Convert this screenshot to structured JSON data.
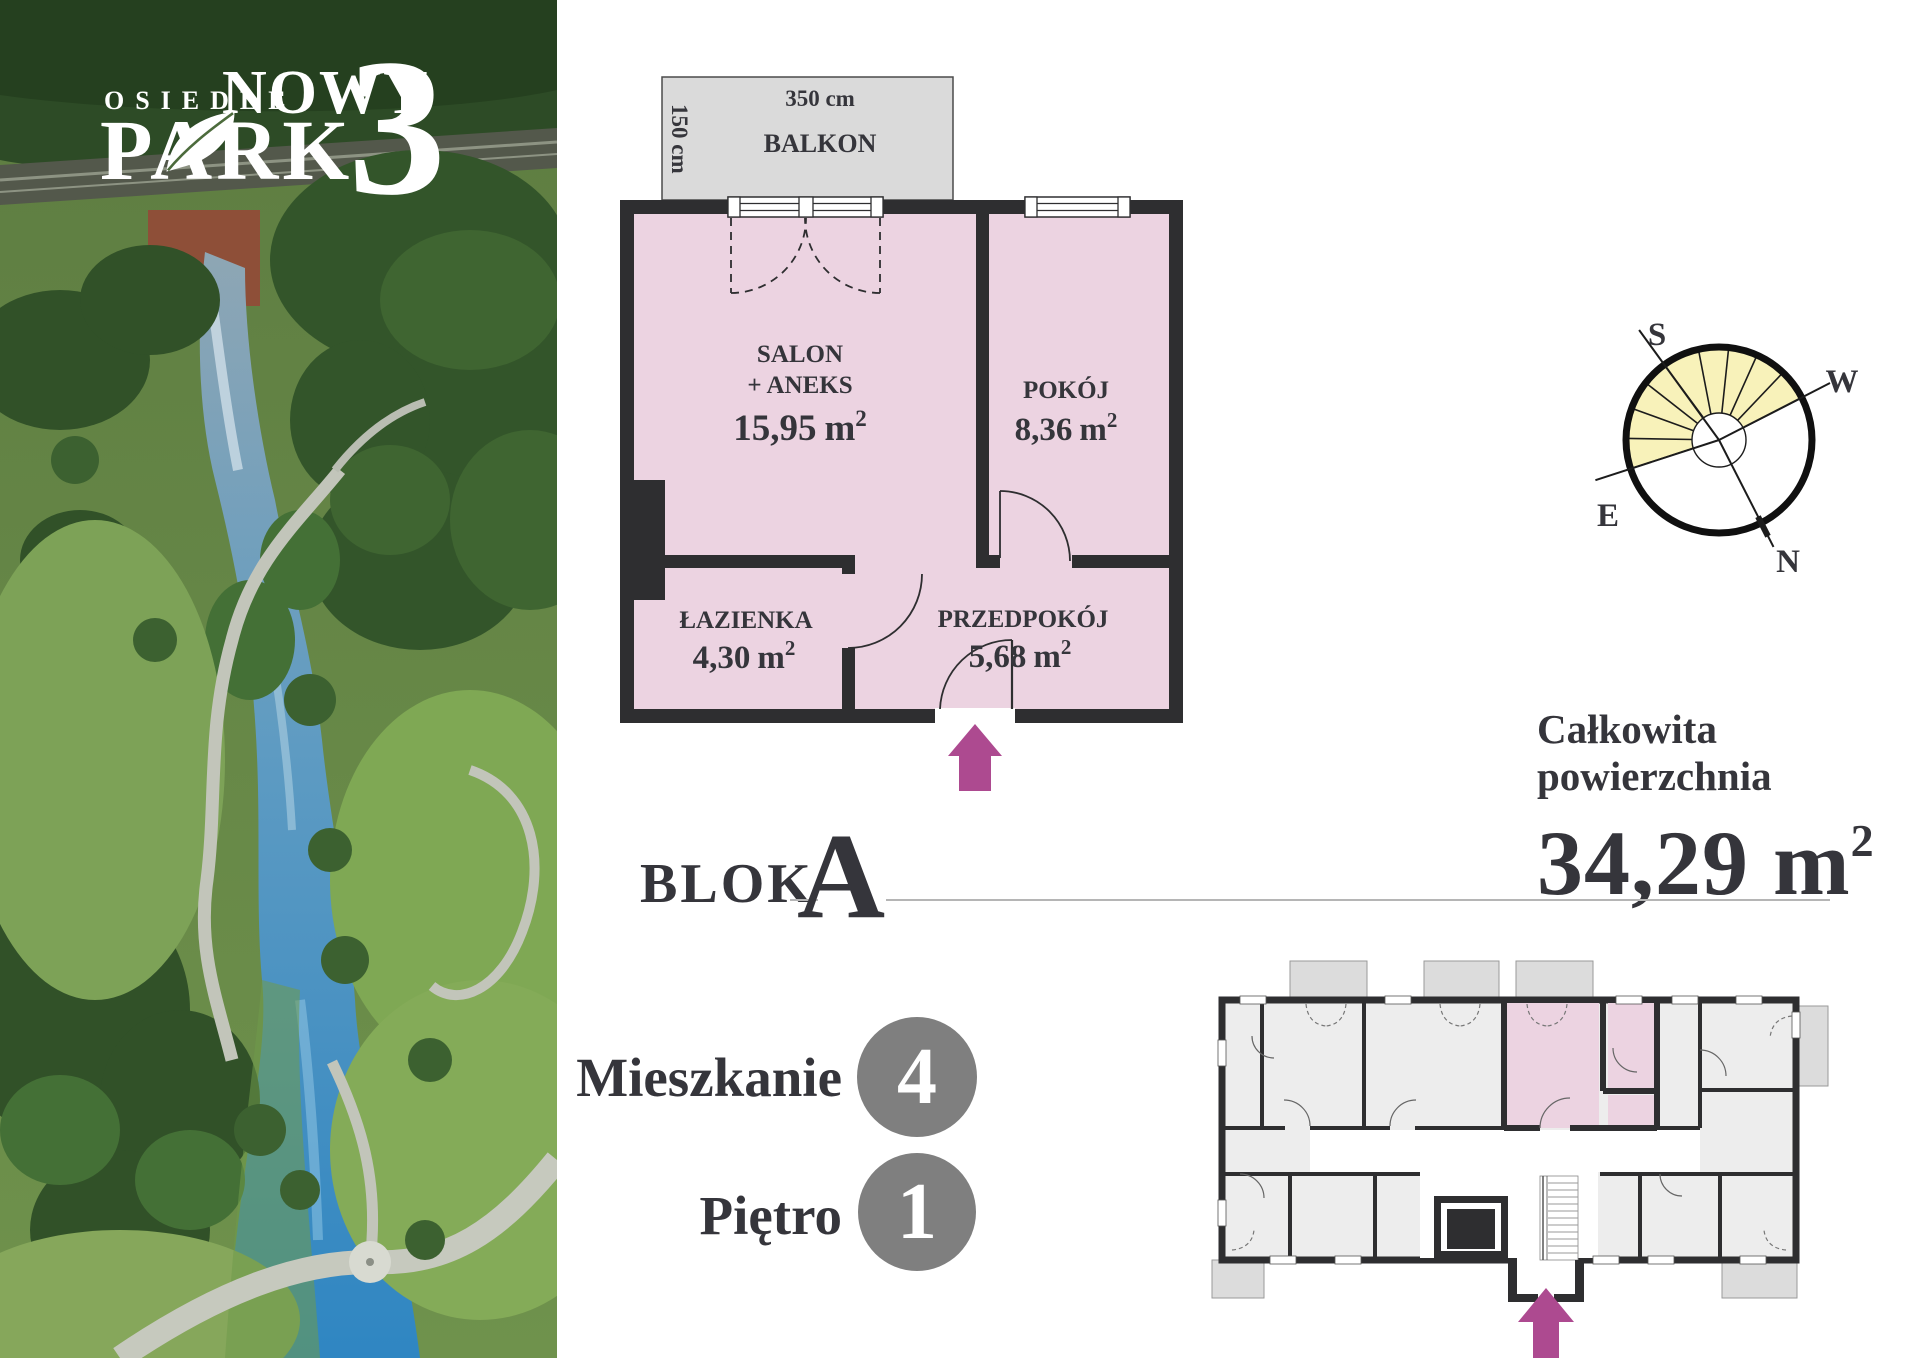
{
  "logo": {
    "kicker": "OSIEDLE",
    "title_top": "NOWY",
    "title_bottom": "PARK",
    "number": "3"
  },
  "floor_plan": {
    "balcony": {
      "name": "BALKON",
      "width": "350 cm",
      "depth": "150 cm"
    },
    "rooms": [
      {
        "id": "salon",
        "lines": [
          "SALON",
          "+ ANEKS"
        ],
        "area": "15,95",
        "unit": "m",
        "sup": "2"
      },
      {
        "id": "pokoj",
        "lines": [
          "POKÓJ"
        ],
        "area": "8,36",
        "unit": "m",
        "sup": "2"
      },
      {
        "id": "lazienka",
        "lines": [
          "ŁAZIENKA"
        ],
        "area": "4,30",
        "unit": "m",
        "sup": "2"
      },
      {
        "id": "przedpokoj",
        "lines": [
          "PRZEDPOKÓJ"
        ],
        "area": "5,68",
        "unit": "m",
        "sup": "2"
      }
    ]
  },
  "block": {
    "label": "BLOK",
    "value": "A"
  },
  "summary": {
    "line1": "Całkowita",
    "line2": "powierzchnia",
    "value": "34,29",
    "unit": "m",
    "sup": "2"
  },
  "unit_details": [
    {
      "label": "Mieszkanie",
      "value": "4"
    },
    {
      "label": "Piętro",
      "value": "1"
    }
  ],
  "compass": {
    "south": "S",
    "west": "W",
    "east": "E",
    "north": "N"
  },
  "colors": {
    "accent_magenta": "#ad4a90",
    "room_pink": "#ecd3e1",
    "balcony_gray": "#dadada",
    "wall_dark": "#2e2e30",
    "text_dark": "#35353b",
    "badge_gray": "#7f7f7f",
    "compass_yellow": "#f8f2ba",
    "overview_room_gray": "#ededed"
  }
}
